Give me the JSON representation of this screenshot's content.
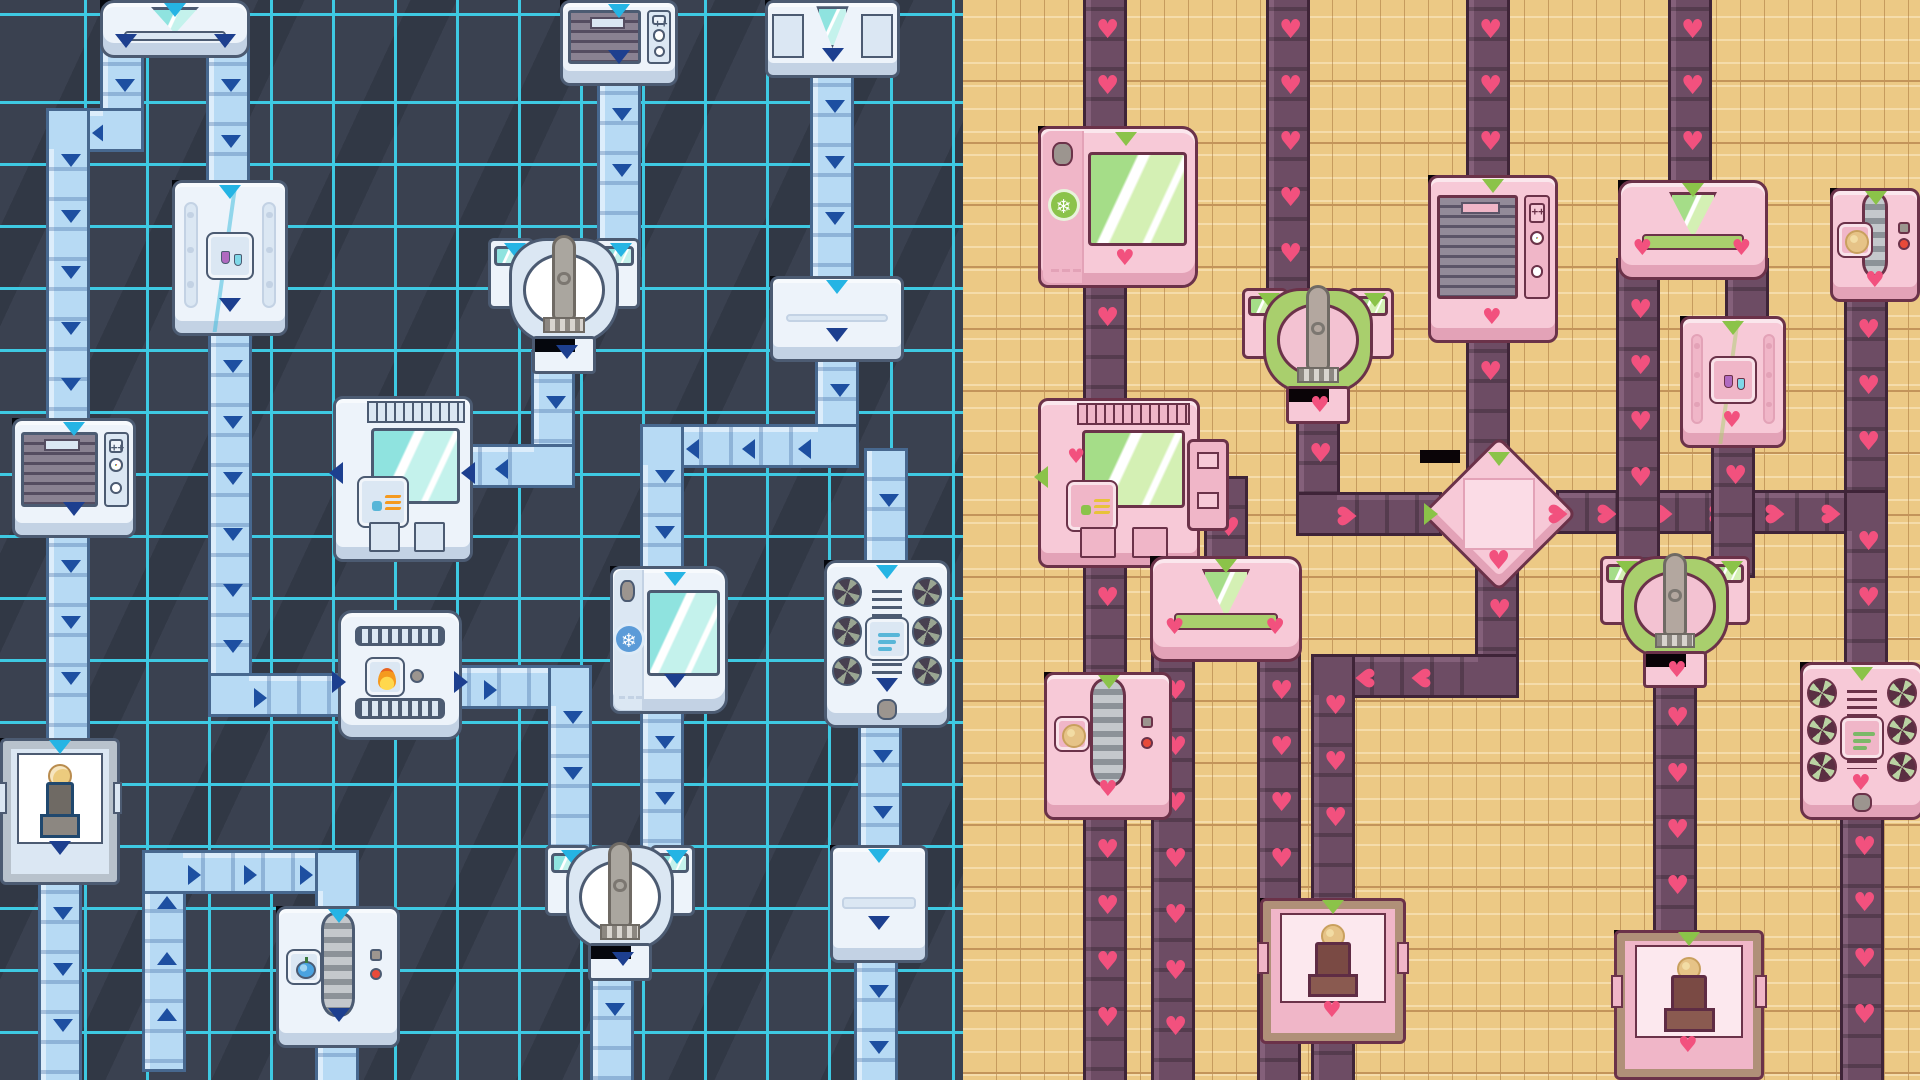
{
  "scene": {
    "name": "factory-conveyor-map-split-themes",
    "width": 1920,
    "height": 1080,
    "split_x": 963,
    "left_zone": "sci-fi-blue-theme",
    "right_zone": "cozy-pink-theme"
  },
  "themes": {
    "blue": {
      "bg": "#3a4150",
      "streak": "rgba(18,22,30,0.22)",
      "grid": "#3ec9e2",
      "grid_step": 62,
      "grid_off_x": 25,
      "grid_off_y": 42,
      "belt": "#b7daf4",
      "beltBorder": "#47688f",
      "beltSeam": "rgba(47,90,150,0.30)",
      "beltEdge": "#dcedfb",
      "chevron": "#1d4fa1",
      "input": "#25b4e4",
      "output": "#1d3f8f",
      "body": "#edf3fa",
      "panel": "#dbe7f3",
      "border": "#4c5b72",
      "shadow": "#c3d2e4",
      "accent": "#35b9dc",
      "glass1": "#c4f2ec",
      "glass2": "#8fe3df",
      "dark": "#20486e",
      "grille1": "#8a8292",
      "grille2": "#554d61",
      "fanbg": "#474050",
      "fanblade": "#9aa592",
      "arm": "#aaa69f",
      "port": "#05070d"
    },
    "pink": {
      "bg": "#ecc985",
      "streak": "rgba(255,245,215,0.45)",
      "grid": "#c3945a",
      "grid_step": 62,
      "grid_off_x": 10,
      "grid_off_y": 20,
      "plank_step": 24,
      "belt": "#6d4c64",
      "beltBorder": "#3f2438",
      "beltSeam": "rgba(0,0,0,0.22)",
      "beltEdge": "#84607a",
      "chevron": "#f2517e",
      "input": "#8bc349",
      "output": "#f2517e",
      "body": "#f7c9d7",
      "panel": "#f0b6c8",
      "border": "#6b3249",
      "shadow": "#e3a2b7",
      "accent": "#a9cf6d",
      "glass1": "#d4f0b4",
      "glass2": "#a5dd88",
      "dark": "#5f2c44",
      "grille1": "#938a99",
      "grille2": "#5c5468",
      "fanbg": "#5a2f42",
      "fanblade": "#b9d3a2",
      "arm": "#b3a79f",
      "port": "#0a0407"
    }
  },
  "icons": {
    "flasks": "chemistry-flasks-icon",
    "heat": "heat-waves-icon",
    "flame": "flame-icon",
    "snowflake": "snowflake-icon",
    "wind": "wind-icon",
    "coin": "coin-icon",
    "fruit": "fruit-icon",
    "cookie": "cookie-icon",
    "dial": "color-dial-icon",
    "clock": "timer-clock-icon",
    "plus": "plus-buttons-icon"
  },
  "glyphs": {
    "heart": "♥",
    "snowflake": "❄"
  },
  "machines": [
    {
      "id": "splitter-a",
      "side": "blue",
      "type": "splitter_y",
      "x": 100,
      "y": 0,
      "w": 150,
      "h": 58
    },
    {
      "id": "ac-top",
      "side": "blue",
      "type": "ac",
      "x": 560,
      "y": 0,
      "w": 118,
      "h": 86
    },
    {
      "id": "dock-n1",
      "side": "blue",
      "type": "dock",
      "x": 765,
      "y": 0,
      "w": 135,
      "h": 78
    },
    {
      "id": "lab-b",
      "side": "blue",
      "type": "lab",
      "x": 172,
      "y": 180,
      "w": 116,
      "h": 156,
      "icon": "flasks"
    },
    {
      "id": "grabber-g",
      "side": "blue",
      "type": "grabber",
      "x": 488,
      "y": 238,
      "w": 152,
      "h": 136
    },
    {
      "id": "relay-n2",
      "side": "blue",
      "type": "relay",
      "x": 770,
      "y": 276,
      "w": 134,
      "h": 86
    },
    {
      "id": "shredder-e",
      "side": "blue",
      "type": "ac",
      "x": 12,
      "y": 418,
      "w": 124,
      "h": 120
    },
    {
      "id": "heater-f",
      "side": "blue",
      "type": "heater",
      "x": 333,
      "y": 396,
      "w": 140,
      "h": 166,
      "icon": "heat"
    },
    {
      "id": "furnace-h",
      "side": "blue",
      "type": "furnace",
      "x": 338,
      "y": 610,
      "w": 124,
      "h": 130,
      "icon": "flame"
    },
    {
      "id": "freezer-i",
      "side": "blue",
      "type": "freezer",
      "x": 610,
      "y": 566,
      "w": 118,
      "h": 148,
      "icon": "snowflake"
    },
    {
      "id": "fan-j",
      "side": "blue",
      "type": "fan",
      "x": 824,
      "y": 560,
      "w": 126,
      "h": 168,
      "icon": "wind"
    },
    {
      "id": "grabber-k",
      "side": "blue",
      "type": "grabber",
      "x": 545,
      "y": 845,
      "w": 150,
      "h": 136
    },
    {
      "id": "mint-c",
      "side": "blue",
      "type": "mint",
      "x": 0,
      "y": 738,
      "w": 120,
      "h": 147,
      "icon": "coin"
    },
    {
      "id": "roller-l",
      "side": "blue",
      "type": "roller",
      "x": 276,
      "y": 906,
      "w": 124,
      "h": 142,
      "icon": "fruit"
    },
    {
      "id": "elbow-m",
      "side": "blue",
      "type": "relay",
      "x": 830,
      "y": 845,
      "w": 98,
      "h": 118
    },
    {
      "id": "freezer-p1",
      "side": "pink",
      "type": "freezer",
      "x": 1038,
      "y": 126,
      "w": 160,
      "h": 162,
      "icon": "snowflake"
    },
    {
      "id": "heater-p2",
      "side": "pink",
      "type": "heater",
      "x": 1038,
      "y": 398,
      "w": 162,
      "h": 170,
      "icon": "heat",
      "sidebox": true
    },
    {
      "id": "roller-p3",
      "side": "pink",
      "type": "roller",
      "x": 1044,
      "y": 672,
      "w": 128,
      "h": 148,
      "icon": "cookie"
    },
    {
      "id": "grabber-p4",
      "side": "pink",
      "type": "grabber",
      "x": 1242,
      "y": 288,
      "w": 152,
      "h": 136
    },
    {
      "id": "diamond-p5",
      "side": "pink",
      "type": "diamond",
      "x": 1420,
      "y": 450,
      "w": 158,
      "h": 128
    },
    {
      "id": "ac-p6",
      "side": "pink",
      "type": "ac",
      "x": 1428,
      "y": 175,
      "w": 130,
      "h": 168
    },
    {
      "id": "fan-p7",
      "side": "pink",
      "type": "fan",
      "x": 1800,
      "y": 662,
      "w": 124,
      "h": 158,
      "icon": "wind"
    },
    {
      "id": "splitter-p8",
      "side": "pink",
      "type": "splitter_y",
      "x": 1150,
      "y": 556,
      "w": 152,
      "h": 106
    },
    {
      "id": "splitter-p9",
      "side": "pink",
      "type": "splitter_y",
      "x": 1618,
      "y": 180,
      "w": 150,
      "h": 100
    },
    {
      "id": "grabber-p10",
      "side": "pink",
      "type": "grabber",
      "x": 1600,
      "y": 556,
      "w": 150,
      "h": 132
    },
    {
      "id": "lab-p11",
      "side": "pink",
      "type": "lab",
      "x": 1680,
      "y": 316,
      "w": 106,
      "h": 132,
      "icon": "flasks"
    },
    {
      "id": "mint-p12",
      "side": "pink",
      "type": "mint",
      "x": 1614,
      "y": 930,
      "w": 150,
      "h": 150,
      "icon": "cookie"
    },
    {
      "id": "mint-p13",
      "side": "pink",
      "type": "mint",
      "x": 1260,
      "y": 898,
      "w": 146,
      "h": 146,
      "icon": "cookie"
    },
    {
      "id": "roller-p14",
      "side": "pink",
      "type": "roller",
      "x": 1830,
      "y": 188,
      "w": 90,
      "h": 114,
      "icon": "cookie"
    }
  ],
  "belts": [
    {
      "side": "blue",
      "pts": [
        [
          122,
          55
        ],
        [
          122,
          130
        ],
        [
          68,
          130
        ],
        [
          68,
          418
        ]
      ]
    },
    {
      "side": "blue",
      "pts": [
        [
          68,
          536
        ],
        [
          68,
          738
        ]
      ]
    },
    {
      "side": "blue",
      "pts": [
        [
          60,
          883
        ],
        [
          60,
          1080
        ]
      ]
    },
    {
      "side": "blue",
      "pts": [
        [
          228,
          55
        ],
        [
          228,
          180
        ]
      ]
    },
    {
      "side": "blue",
      "pts": [
        [
          230,
          336
        ],
        [
          230,
          695
        ],
        [
          338,
          695
        ]
      ]
    },
    {
      "side": "blue",
      "pts": [
        [
          460,
          687
        ],
        [
          570,
          687
        ],
        [
          570,
          845
        ]
      ]
    },
    {
      "side": "blue",
      "pts": [
        [
          619,
          84
        ],
        [
          619,
          238
        ]
      ]
    },
    {
      "side": "blue",
      "pts": [
        [
          553,
          372
        ],
        [
          553,
          466
        ],
        [
          471,
          466
        ]
      ]
    },
    {
      "side": "blue",
      "pts": [
        [
          832,
          76
        ],
        [
          832,
          276
        ]
      ]
    },
    {
      "side": "blue",
      "pts": [
        [
          837,
          360
        ],
        [
          837,
          446
        ],
        [
          662,
          446
        ],
        [
          662,
          566
        ]
      ]
    },
    {
      "side": "blue",
      "pts": [
        [
          662,
          712
        ],
        [
          662,
          845
        ]
      ]
    },
    {
      "side": "blue",
      "pts": [
        [
          612,
          979
        ],
        [
          612,
          1080
        ]
      ]
    },
    {
      "side": "blue",
      "pts": [
        [
          886,
          470
        ],
        [
          886,
          560
        ]
      ]
    },
    {
      "side": "blue",
      "pts": [
        [
          880,
          726
        ],
        [
          880,
          845
        ]
      ]
    },
    {
      "side": "blue",
      "pts": [
        [
          876,
          961
        ],
        [
          876,
          1080
        ]
      ]
    },
    {
      "side": "blue",
      "pts": [
        [
          164,
          1050
        ],
        [
          164,
          872
        ],
        [
          337,
          872
        ],
        [
          337,
          906
        ]
      ]
    },
    {
      "side": "blue",
      "pts": [
        [
          337,
          1046
        ],
        [
          337,
          1080
        ]
      ]
    },
    {
      "side": "pink",
      "pts": [
        [
          1105,
          0
        ],
        [
          1105,
          126
        ]
      ]
    },
    {
      "side": "pink",
      "pts": [
        [
          1105,
          288
        ],
        [
          1105,
          398
        ]
      ]
    },
    {
      "side": "pink",
      "pts": [
        [
          1105,
          568
        ],
        [
          1105,
          672
        ]
      ]
    },
    {
      "side": "pink",
      "pts": [
        [
          1105,
          820
        ],
        [
          1105,
          1080
        ]
      ]
    },
    {
      "side": "pink",
      "pts": [
        [
          1288,
          0
        ],
        [
          1288,
          288
        ]
      ]
    },
    {
      "side": "pink",
      "pts": [
        [
          1318,
          424
        ],
        [
          1318,
          514
        ],
        [
          1420,
          514
        ]
      ]
    },
    {
      "side": "pink",
      "pts": [
        [
          1488,
          0
        ],
        [
          1488,
          175
        ]
      ]
    },
    {
      "side": "pink",
      "pts": [
        [
          1488,
          342
        ],
        [
          1488,
          450
        ]
      ]
    },
    {
      "side": "pink",
      "pts": [
        [
          1866,
          300
        ],
        [
          1866,
          512
        ]
      ]
    },
    {
      "side": "pink",
      "pts": [
        [
          1578,
          512
        ],
        [
          1866,
          512
        ],
        [
          1866,
          662
        ]
      ]
    },
    {
      "side": "pink",
      "pts": [
        [
          1497,
          580
        ],
        [
          1497,
          676
        ],
        [
          1333,
          676
        ],
        [
          1333,
          898
        ]
      ]
    },
    {
      "side": "pink",
      "pts": [
        [
          1333,
          1044
        ],
        [
          1333,
          1080
        ]
      ]
    },
    {
      "side": "pink",
      "pts": [
        [
          1226,
          498
        ],
        [
          1226,
          556
        ]
      ]
    },
    {
      "side": "pink",
      "pts": [
        [
          1173,
          661
        ],
        [
          1173,
          1080
        ]
      ]
    },
    {
      "side": "pink",
      "pts": [
        [
          1279,
          661
        ],
        [
          1279,
          1080
        ]
      ]
    },
    {
      "side": "pink",
      "pts": [
        [
          1690,
          0
        ],
        [
          1690,
          180
        ]
      ]
    },
    {
      "side": "pink",
      "pts": [
        [
          1638,
          280
        ],
        [
          1638,
          556
        ]
      ]
    },
    {
      "side": "pink",
      "pts": [
        [
          1747,
          280
        ],
        [
          1747,
          316
        ]
      ]
    },
    {
      "side": "pink",
      "pts": [
        [
          1733,
          446
        ],
        [
          1733,
          556
        ]
      ]
    },
    {
      "side": "pink",
      "pts": [
        [
          1675,
          688
        ],
        [
          1675,
          930
        ]
      ]
    },
    {
      "side": "pink",
      "pts": [
        [
          1862,
          817
        ],
        [
          1862,
          1080
        ]
      ]
    }
  ]
}
